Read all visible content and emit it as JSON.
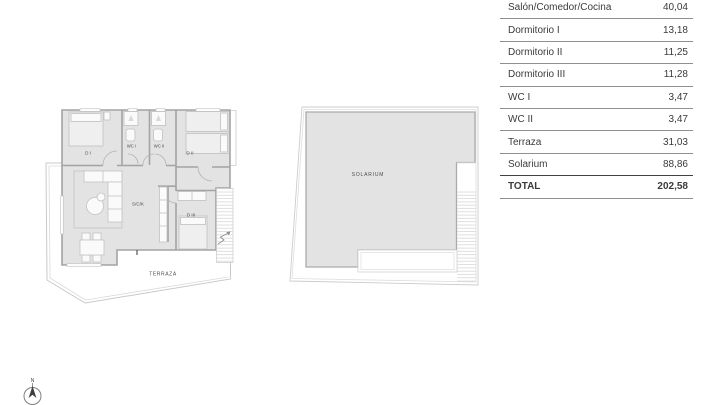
{
  "area_table": {
    "rows": [
      {
        "label": "Salón/Comedor/Cocina",
        "value": "40,04"
      },
      {
        "label": "Dormitorio I",
        "value": "13,18"
      },
      {
        "label": "Dormitorio II",
        "value": "11,25"
      },
      {
        "label": "Dormitorio III",
        "value": "11,28"
      },
      {
        "label": "WC I",
        "value": "3,47"
      },
      {
        "label": "WC II",
        "value": "3,47"
      },
      {
        "label": "Terraza",
        "value": "31,03"
      },
      {
        "label": "Solarium",
        "value": "88,86"
      },
      {
        "label": "TOTAL",
        "value": "202,58",
        "is_total": true
      }
    ]
  },
  "floor_plan": {
    "labels": {
      "dormitorio1": "D I",
      "wc1": "WC I",
      "wc2": "WC II",
      "dormitorio2": "D II",
      "salon": "S/C/K",
      "dormitorio3": "D III",
      "terraza": "TERRAZA"
    }
  },
  "solarium_plan": {
    "label": "SOLARIUM"
  },
  "compass": {
    "north": "N"
  },
  "colors": {
    "floor_fill": "#e3e3e3",
    "wall": "#a3a3a3",
    "table_line": "#8f8f8f",
    "total_line": "#424242",
    "text": "#3b3b3b"
  }
}
